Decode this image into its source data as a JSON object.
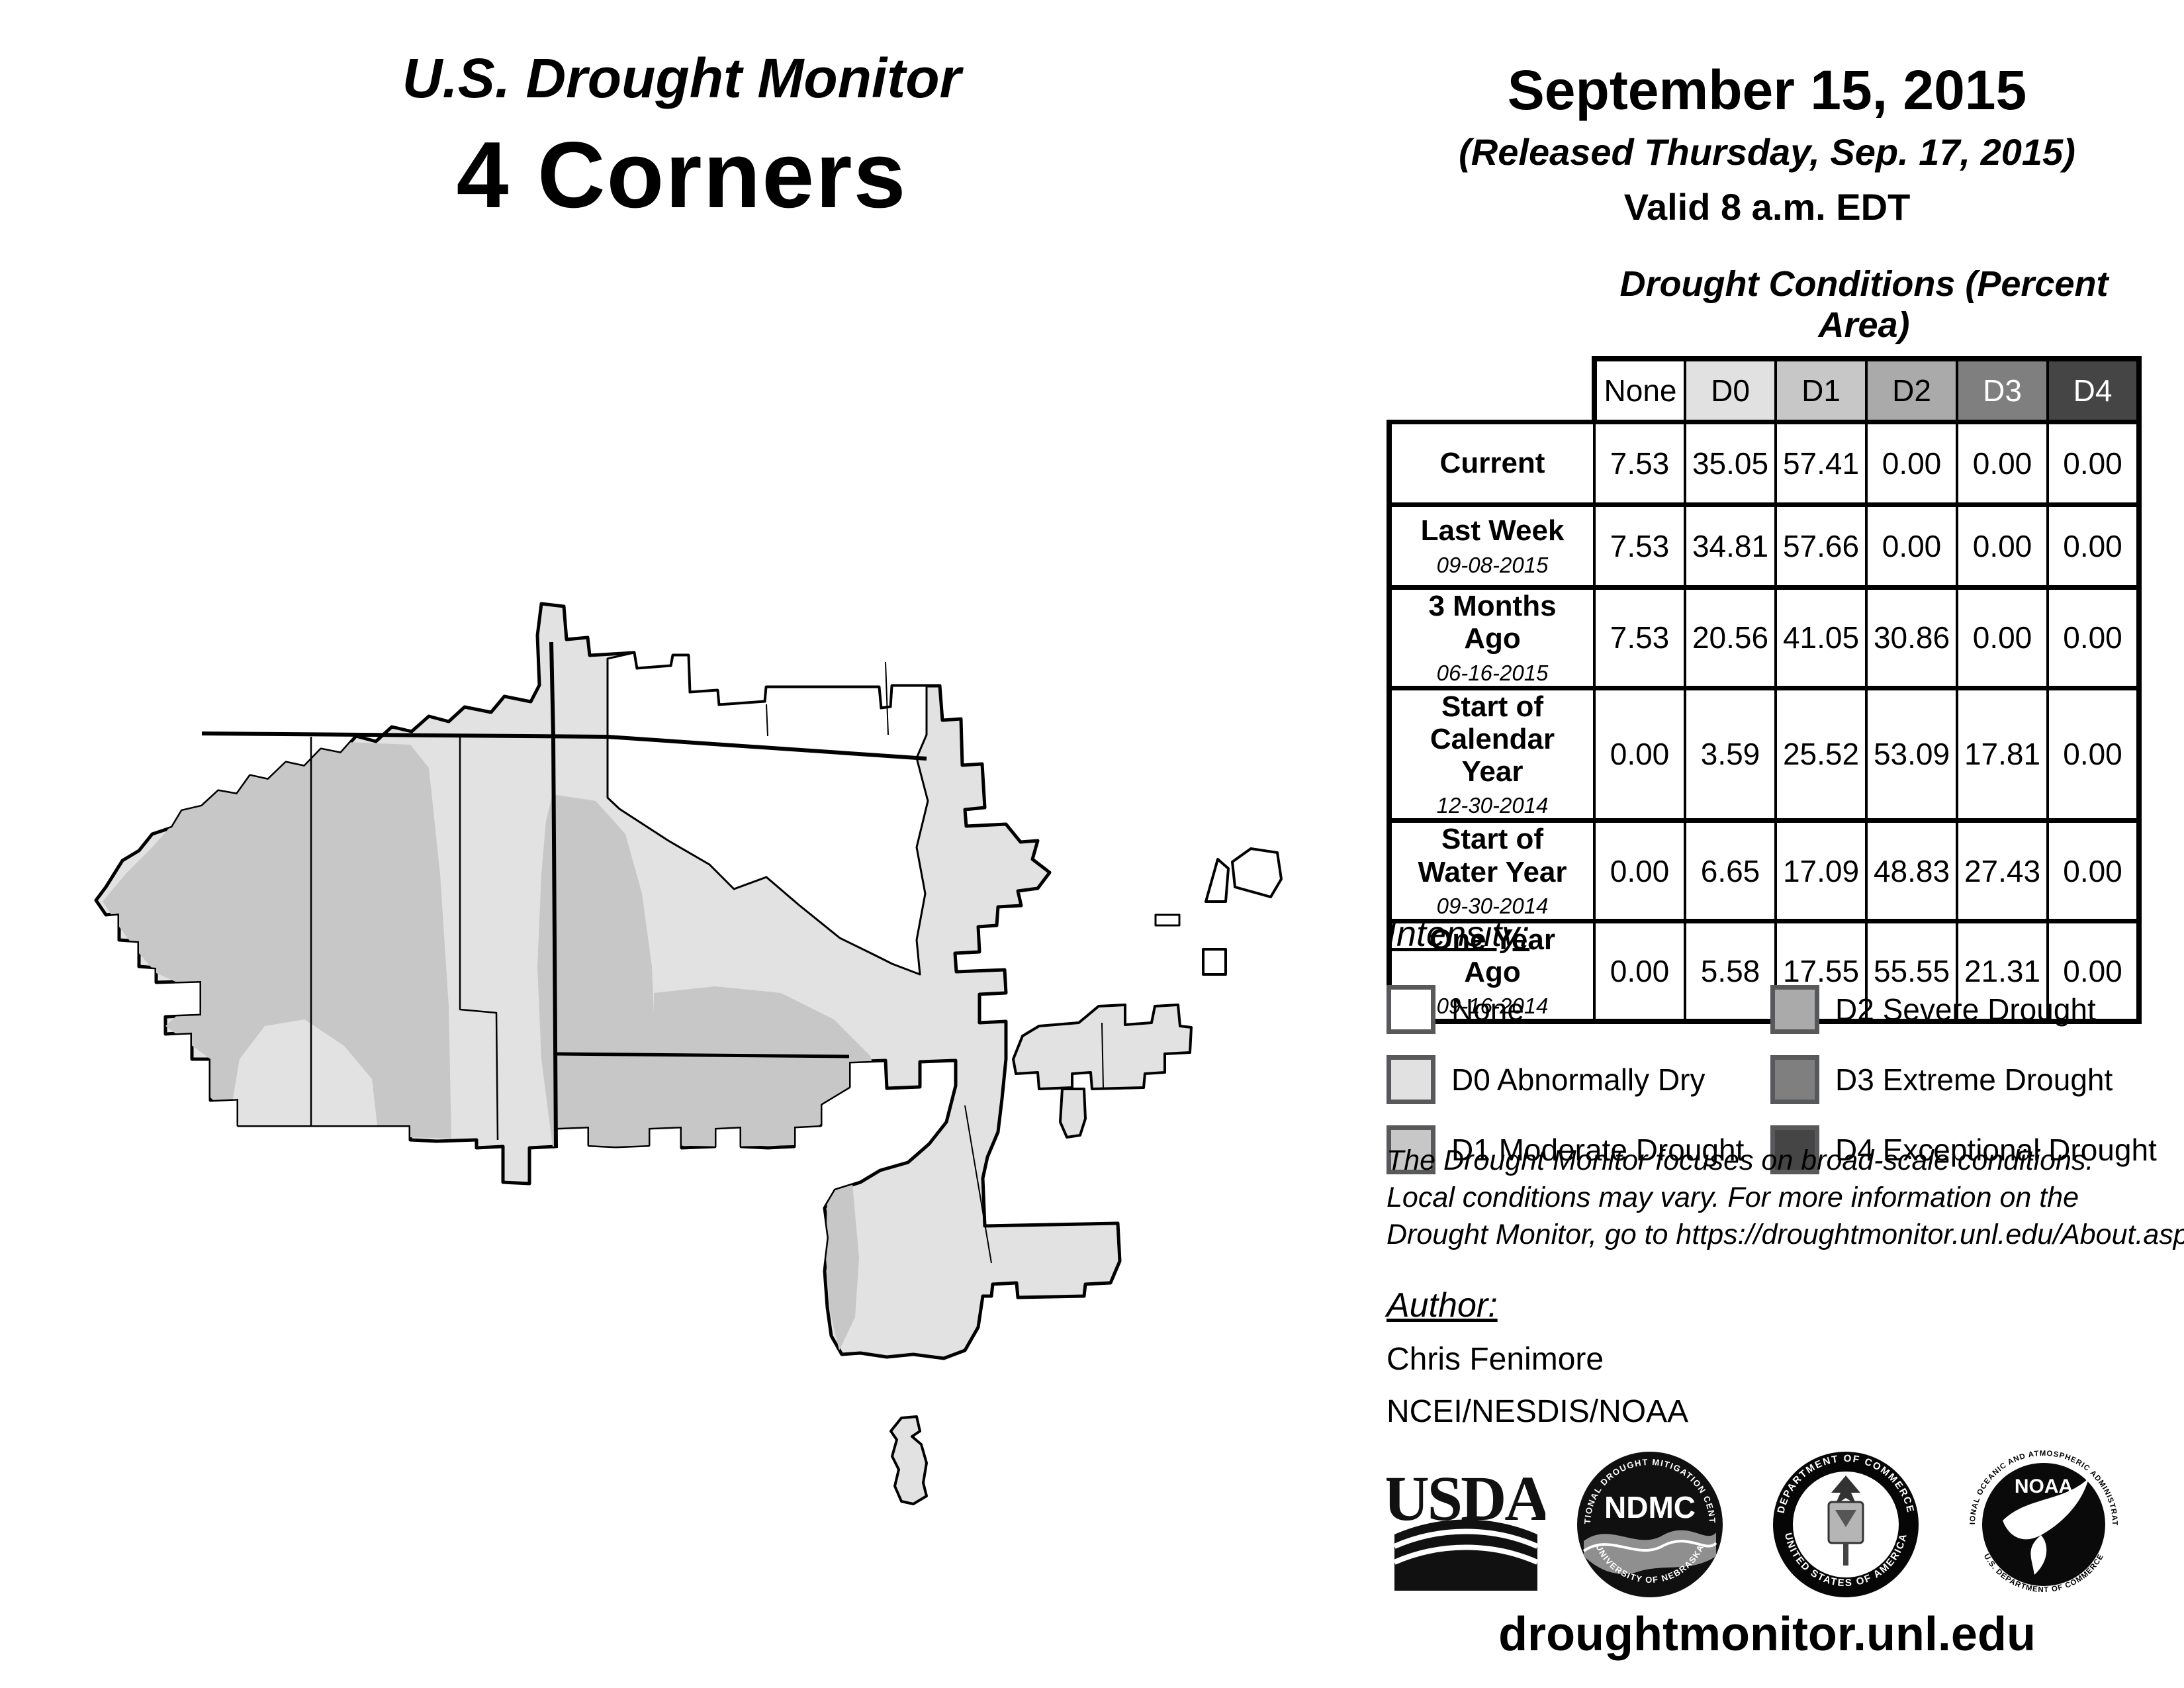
{
  "title": {
    "line1": "U.S. Drought Monitor",
    "line2": "4 Corners"
  },
  "date_block": {
    "date": "September 15, 2015",
    "released": "(Released Thursday, Sep. 17, 2015)",
    "valid": "Valid 8 a.m. EDT"
  },
  "table": {
    "title": "Drought Conditions (Percent Area)",
    "columns": [
      "None",
      "D0",
      "D1",
      "D2",
      "D3",
      "D4"
    ],
    "rows": [
      {
        "label": "Current",
        "date": "",
        "values": [
          "7.53",
          "35.05",
          "57.41",
          "0.00",
          "0.00",
          "0.00"
        ]
      },
      {
        "label": "Last Week",
        "date": "09-08-2015",
        "values": [
          "7.53",
          "34.81",
          "57.66",
          "0.00",
          "0.00",
          "0.00"
        ]
      },
      {
        "label": "3 Months Ago",
        "date": "06-16-2015",
        "values": [
          "7.53",
          "20.56",
          "41.05",
          "30.86",
          "0.00",
          "0.00"
        ]
      },
      {
        "label": "Start of Calendar Year",
        "date": "12-30-2014",
        "values": [
          "0.00",
          "3.59",
          "25.52",
          "53.09",
          "17.81",
          "0.00"
        ]
      },
      {
        "label": "Start of Water Year",
        "date": "09-30-2014",
        "values": [
          "0.00",
          "6.65",
          "17.09",
          "48.83",
          "27.43",
          "0.00"
        ]
      },
      {
        "label": "One Year Ago",
        "date": "09-16-2014",
        "values": [
          "0.00",
          "5.58",
          "17.55",
          "55.55",
          "21.31",
          "0.00"
        ]
      }
    ]
  },
  "legend": {
    "heading": "Intensity:",
    "items": [
      {
        "label": "None",
        "color": "#ffffff"
      },
      {
        "label": "D0 Abnormally Dry",
        "color": "#e1e1e1"
      },
      {
        "label": "D1 Moderate Drought",
        "color": "#c7c7c7"
      },
      {
        "label": "D2 Severe Drought",
        "color": "#aaaaaa"
      },
      {
        "label": "D3 Extreme Drought",
        "color": "#7f7f7f"
      },
      {
        "label": "D4 Exceptional Drought",
        "color": "#454545"
      }
    ]
  },
  "disclaimer": {
    "line1": "The Drought Monitor focuses on broad-scale conditions.",
    "line2": "Local conditions may vary. For more information on the",
    "line3": "Drought Monitor, go to https://droughtmonitor.unl.edu/About.aspx"
  },
  "author": {
    "heading": "Author:",
    "name": "Chris Fenimore",
    "org": "NCEI/NESDIS/NOAA"
  },
  "logos": {
    "usda": "USDA",
    "ndmc": "NDMC",
    "ndmc_top": "NATIONAL DROUGHT MITIGATION CENTER",
    "ndmc_bottom": "UNIVERSITY OF NEBRASKA",
    "doc_top": "DEPARTMENT OF COMMERCE",
    "doc_bottom": "UNITED STATES OF AMERICA",
    "noaa": "NOAA",
    "noaa_top": "NATIONAL OCEANIC AND ATMOSPHERIC ADMINISTRATION",
    "noaa_bottom": "U.S. DEPARTMENT OF COMMERCE"
  },
  "footer": {
    "url": "droughtmonitor.unl.edu"
  },
  "map": {
    "region_colors": {
      "none": "#ffffff",
      "d0": "#e2e2e2",
      "d1": "#c7c7c7"
    }
  }
}
